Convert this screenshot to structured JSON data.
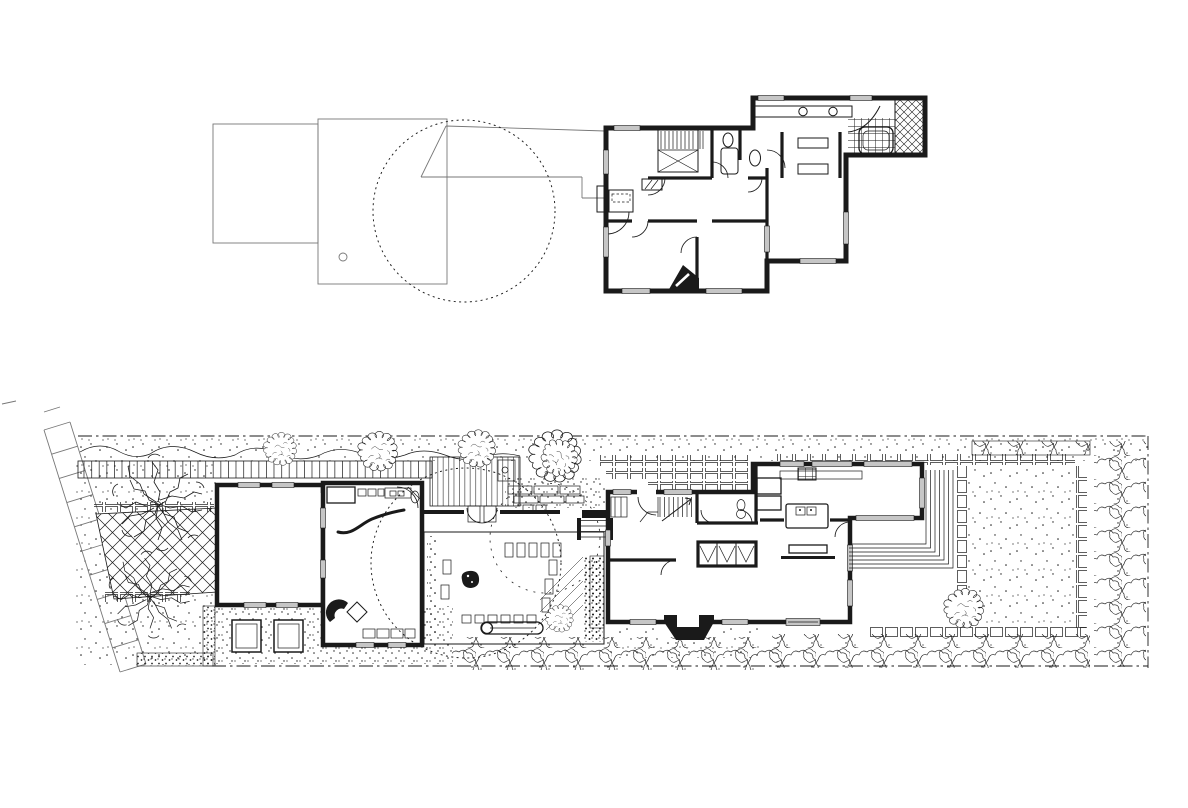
{
  "document": {
    "title": "Scanned black-and-white architectural drawing: upper floor plan above, ground floor and garden site plan below",
    "colors": {
      "ink": "#1a1a1a",
      "paper": "#ffffff",
      "pencil": "#777777",
      "glazing": "#c6c6c6"
    }
  },
  "drawings": {
    "upper_floor_plan": {
      "title": "Upper floor plan with pencil roof outlines of garage and studio and dashed tree-canopy circle",
      "features": [
        "roof outline of garage",
        "roof outline of studio with vent",
        "dashed tree canopy",
        "stair with cross-braced well",
        "hall",
        "bathroom with tub and wc",
        "three bedrooms",
        "master bedroom with dressing closets",
        "vanity with twin basins",
        "tiled bathroom with tub",
        "cross-hatched shower",
        "corner chimney"
      ]
    },
    "site_plan": {
      "title": "Ground floor and site plan of the long garden plot",
      "features": [
        "paved sidewalk strip",
        "lattice-paved court",
        "two mature branching trees",
        "garage",
        "studio with kitchenette and curved screen wall",
        "gravel courtyard with stepping stones, boulder and bench",
        "board walkway with pergola rungs",
        "clipped hedges",
        "square planters",
        "main house with entry stair, bath, closets, kitchen island, dining table and fireplace",
        "terraced corner steps",
        "brick-edged lawn",
        "perimeter planting and property line",
        "dashed existing-tree circles",
        "round clipped trees along the walk"
      ]
    }
  }
}
